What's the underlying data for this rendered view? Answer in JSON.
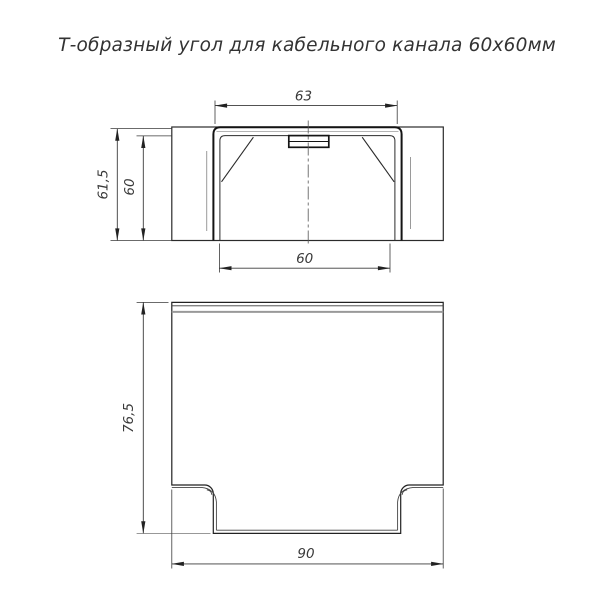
{
  "title": "Т-образный угол для кабельного канала 60х60мм",
  "views": {
    "front": {
      "label": "front-view",
      "dims": {
        "top_width": "63",
        "outer_height": "61,5",
        "inner_height": "60",
        "bottom_width": "60"
      }
    },
    "plan": {
      "label": "plan-view",
      "dims": {
        "height": "76,5",
        "width": "90"
      }
    }
  },
  "colors": {
    "background": "#ffffff",
    "main_line": "#1f1f1f",
    "thin_line": "#2b2b2b",
    "auxiliary_line": "#999999",
    "dimension_line": "#3a3a3a"
  }
}
